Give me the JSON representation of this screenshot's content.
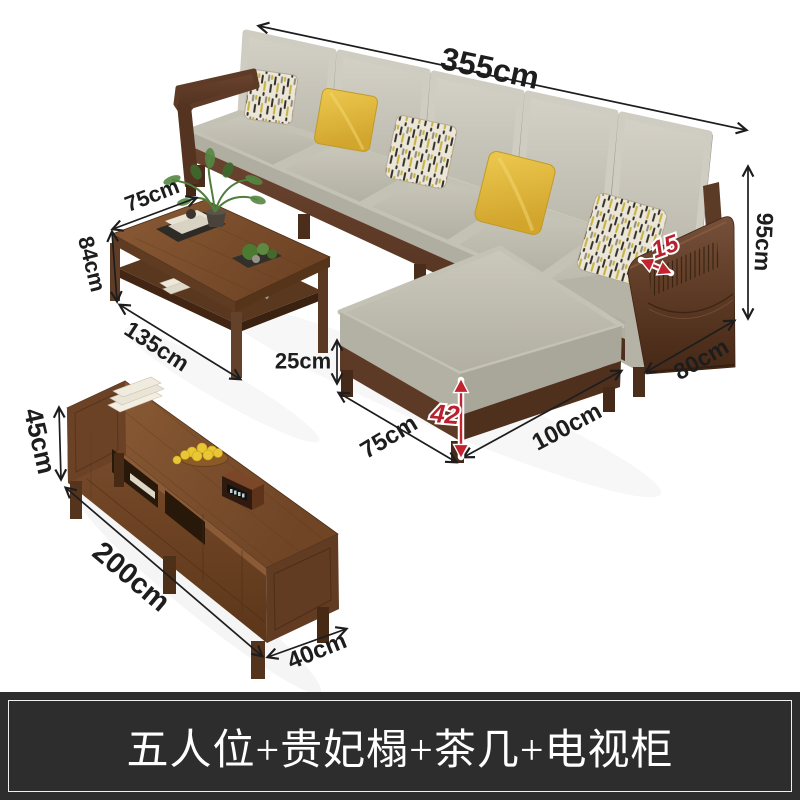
{
  "banner": {
    "label": "五人位+贵妃榻+茶几+电视柜"
  },
  "sofa": {
    "width_label": "355cm",
    "height_label": "95cm",
    "armrest_width_label": "15",
    "depth_label": "80cm",
    "chaise_length_label": "100cm",
    "chaise_width_label": "75cm",
    "seat_height_label": "42",
    "base_height_label": "25cm"
  },
  "coffee_table": {
    "width_label": "75cm",
    "height_label": "84cm",
    "length_label": "135cm"
  },
  "tv_cabinet": {
    "height_label": "45cm",
    "length_label": "200cm",
    "depth_label": "40cm"
  },
  "colors": {
    "background": "#ffffff",
    "dimension_text": "#1d1d1d",
    "accent_red": "#b8222f",
    "banner_background": "#2d2d2d",
    "banner_border": "#efefef",
    "banner_text": "#ffffff",
    "sofa_wood": "#5e3b27",
    "cabinet_wood": "#7a4d2c",
    "cushion_gray": "#c8c5ba",
    "pillow_yellow": "#e2b93f"
  }
}
